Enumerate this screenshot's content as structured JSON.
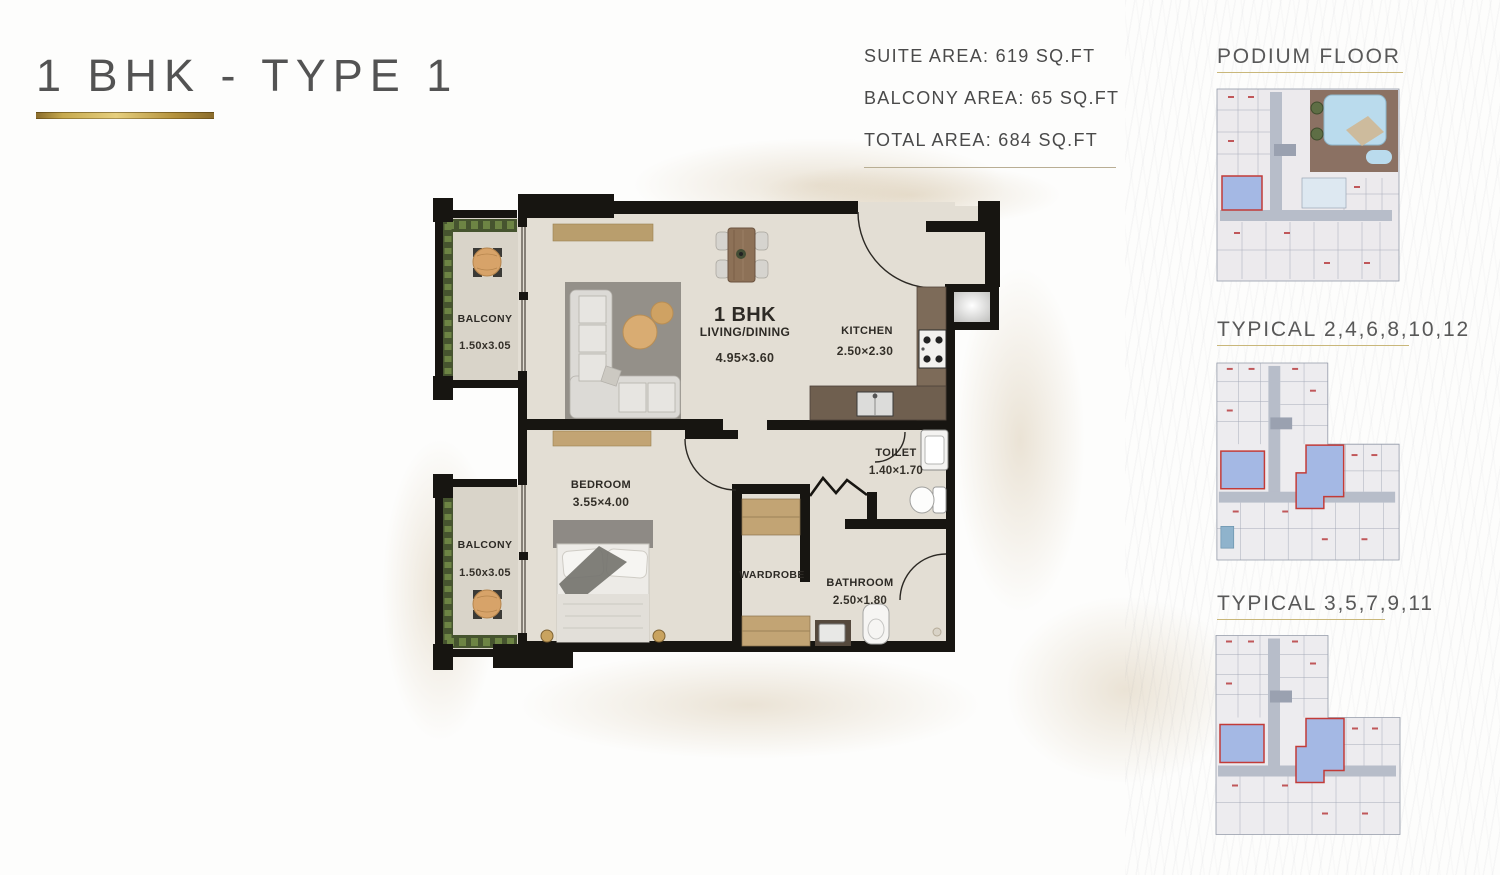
{
  "header": {
    "title": "1 BHK - TYPE 1"
  },
  "areas": {
    "suite": "SUITE AREA: 619 SQ.FT",
    "balcony": "BALCONY AREA: 65 SQ.FT",
    "total": "TOTAL AREA: 684 SQ.FT"
  },
  "plan": {
    "unit": {
      "title": "1 BHK",
      "subtitle": "LIVING/DINING",
      "dim": "4.95×3.60"
    },
    "kitchen": {
      "name": "KITCHEN",
      "dim": "2.50×2.30"
    },
    "bedroom": {
      "name": "BEDROOM",
      "dim": "3.55×4.00"
    },
    "toilet": {
      "name": "TOILET",
      "dim": "1.40×1.70"
    },
    "bathroom": {
      "name": "BATHROOM",
      "dim": "2.50×1.80"
    },
    "wardrobe": {
      "name": "WARDROBE"
    },
    "balcony_top": {
      "name": "BALCONY",
      "dim": "1.50x3.05"
    },
    "balcony_bottom": {
      "name": "BALCONY",
      "dim": "1.50x3.05"
    }
  },
  "sidebar": {
    "sections": [
      {
        "title": "PODIUM FLOOR"
      },
      {
        "title": "TYPICAL 2,4,6,8,10,12"
      },
      {
        "title": "TYPICAL 3,5,7,9,11"
      }
    ]
  },
  "colors": {
    "accent_gold": "#c0a04e",
    "wall": "#171511",
    "floor": "#e3ded4",
    "highlight_fill": "#a4b8e4",
    "highlight_stroke": "#c23b38"
  }
}
